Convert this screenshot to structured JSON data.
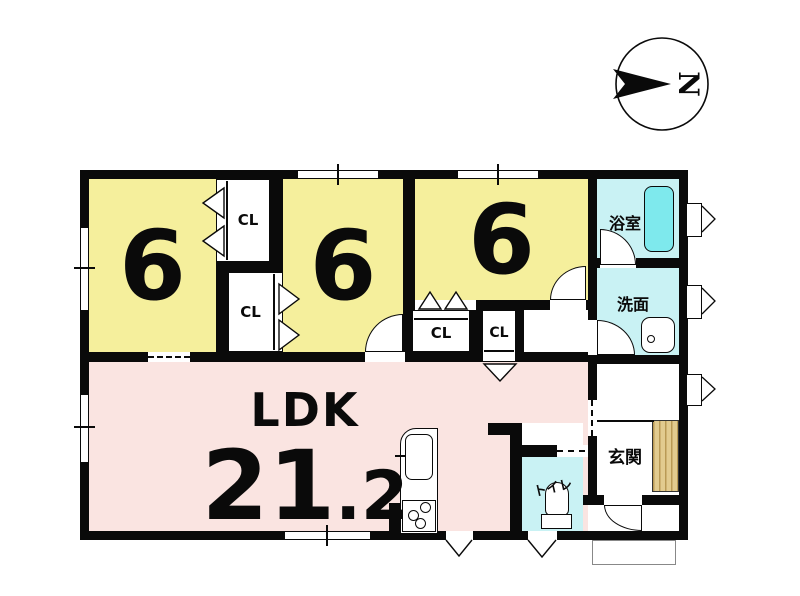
{
  "compass": {
    "north_label": "N"
  },
  "rooms": {
    "bedroom_left": {
      "size_label": "6"
    },
    "bedroom_middle": {
      "size_label": "6"
    },
    "bedroom_right": {
      "size_label": "6"
    },
    "ldk": {
      "name": "LDK",
      "size_main": "21",
      "size_sub": ".2"
    },
    "bath": {
      "name": "浴室"
    },
    "washroom": {
      "name": "洗面"
    },
    "toilet": {
      "name": "トイレ"
    },
    "entrance": {
      "name": "玄関"
    }
  },
  "closets": [
    {
      "label": "CL"
    },
    {
      "label": "CL"
    },
    {
      "label": "CL"
    },
    {
      "label": "CL"
    }
  ],
  "colors": {
    "room_yellow": "#f5ef9c",
    "ldk_pink": "#fae4e1",
    "wet_cyan": "#c9f2f4",
    "tub_cyan": "#7ee9ed",
    "wall_black": "#0a0a0a",
    "step_tan": "#e2cb8f"
  }
}
